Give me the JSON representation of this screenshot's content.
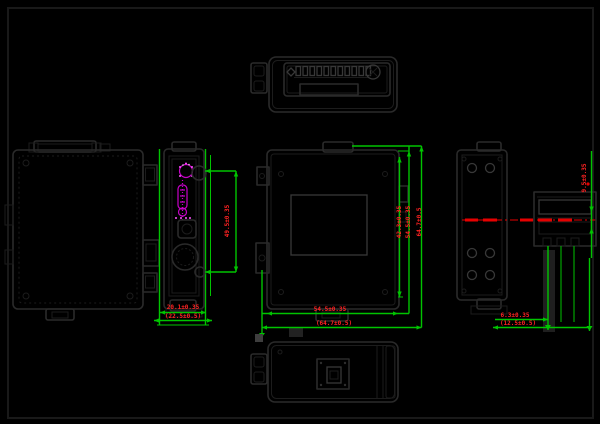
{
  "colors": {
    "background": "#000000",
    "frame": "#191919",
    "outline": "#2a2a2a",
    "outline_faint": "#1c1c1c",
    "outline_light": "#383838",
    "dimension_line": "#00c400",
    "dimension_text": "#ff2222",
    "highlight_magenta": "#c800c8",
    "highlight_dot": "#ff50ff",
    "centerline_red": "#e60000",
    "gray_artifact": "#3e3e3e"
  },
  "dimensions": {
    "side_view": {
      "height": "49.5±0.35",
      "depth": "20.1±0.35",
      "depth_overall": "(22.5±0.5)"
    },
    "front_view": {
      "height_inner": "42.3±0.35",
      "height_mid": "54.5±0.35",
      "height_overall": "64.7±0.5",
      "width_body": "54.5±0.35",
      "width_overall": "(64.7±0.5)"
    },
    "detail_view": {
      "rail_height": "9.5±0.35",
      "width_inner": "6.3±0.35",
      "width_overall": "(12.5±0.5)"
    }
  }
}
